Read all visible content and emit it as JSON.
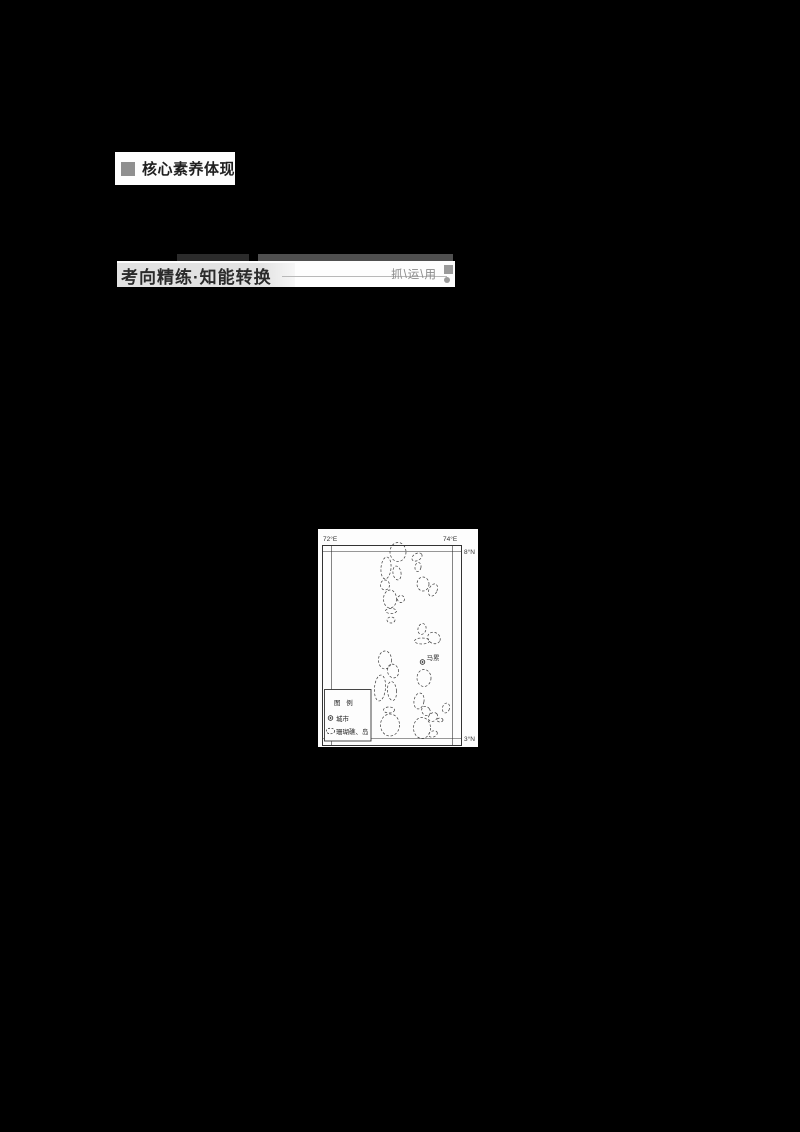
{
  "page": {
    "background_color": "#000000"
  },
  "section_core_literacy": {
    "title": "核心素养体现"
  },
  "section_exam_practice": {
    "title": "考向精练·知能转换",
    "tagline": "抓\\运\\用"
  },
  "map_figure": {
    "coordinate_labels": {
      "top_left_lon": "72°E",
      "top_right_lon": "74°E",
      "right_top_lat": "8°N",
      "right_bottom_lat": "3°N"
    },
    "city": {
      "marker": "circled-dot",
      "name": "马累"
    },
    "legend": {
      "title": "图 例",
      "items": [
        {
          "symbol": "circled-dot",
          "label": "城市"
        },
        {
          "symbol": "dashed-ellipse",
          "label": "珊瑚礁、岛"
        }
      ]
    },
    "atolls": [
      [
        80,
        23,
        8,
        9.5,
        0
      ],
      [
        99,
        28,
        5.5,
        3.5,
        -30
      ],
      [
        100,
        38,
        3,
        4.5,
        10
      ],
      [
        68,
        39,
        5,
        11,
        5
      ],
      [
        79,
        44,
        4,
        7,
        -10
      ],
      [
        67,
        56,
        4.5,
        5,
        0
      ],
      [
        105,
        55,
        6,
        7,
        0
      ],
      [
        115,
        61,
        4,
        6.5,
        25
      ],
      [
        72,
        70,
        6.5,
        9,
        0
      ],
      [
        83,
        70,
        3.5,
        3.5,
        0
      ],
      [
        73,
        82,
        5.5,
        2.5,
        0
      ],
      [
        73,
        91,
        4,
        3,
        0
      ],
      [
        104,
        100,
        4,
        5.5,
        15
      ],
      [
        116,
        109,
        6.5,
        5.5,
        30
      ],
      [
        104,
        112,
        7.5,
        3,
        0
      ],
      [
        106,
        149,
        7,
        8.5,
        0
      ],
      [
        67,
        131,
        6.5,
        9,
        0
      ],
      [
        75,
        142,
        5.5,
        7,
        -15
      ],
      [
        62,
        159,
        5.5,
        13,
        5
      ],
      [
        74,
        162,
        4.5,
        9.5,
        -5
      ],
      [
        71,
        181,
        5.5,
        3,
        0
      ],
      [
        72,
        196,
        9.5,
        11,
        0
      ],
      [
        101,
        172,
        5,
        8,
        10
      ],
      [
        108,
        182,
        4,
        5,
        -35
      ],
      [
        115,
        188,
        5,
        4,
        -40
      ],
      [
        128,
        179,
        3.5,
        5,
        15
      ],
      [
        104,
        199,
        8.5,
        10.5,
        0
      ],
      [
        115,
        205,
        4.5,
        3,
        -20
      ],
      [
        122,
        191,
        3,
        2,
        0
      ]
    ]
  },
  "colors": {
    "accent_gray": "#9a9a9a",
    "bar_dark": "#2b2b2b",
    "bar_mid": "#4f4f4f",
    "map_line": "#333333",
    "atoll_line": "#3a3a3a"
  }
}
